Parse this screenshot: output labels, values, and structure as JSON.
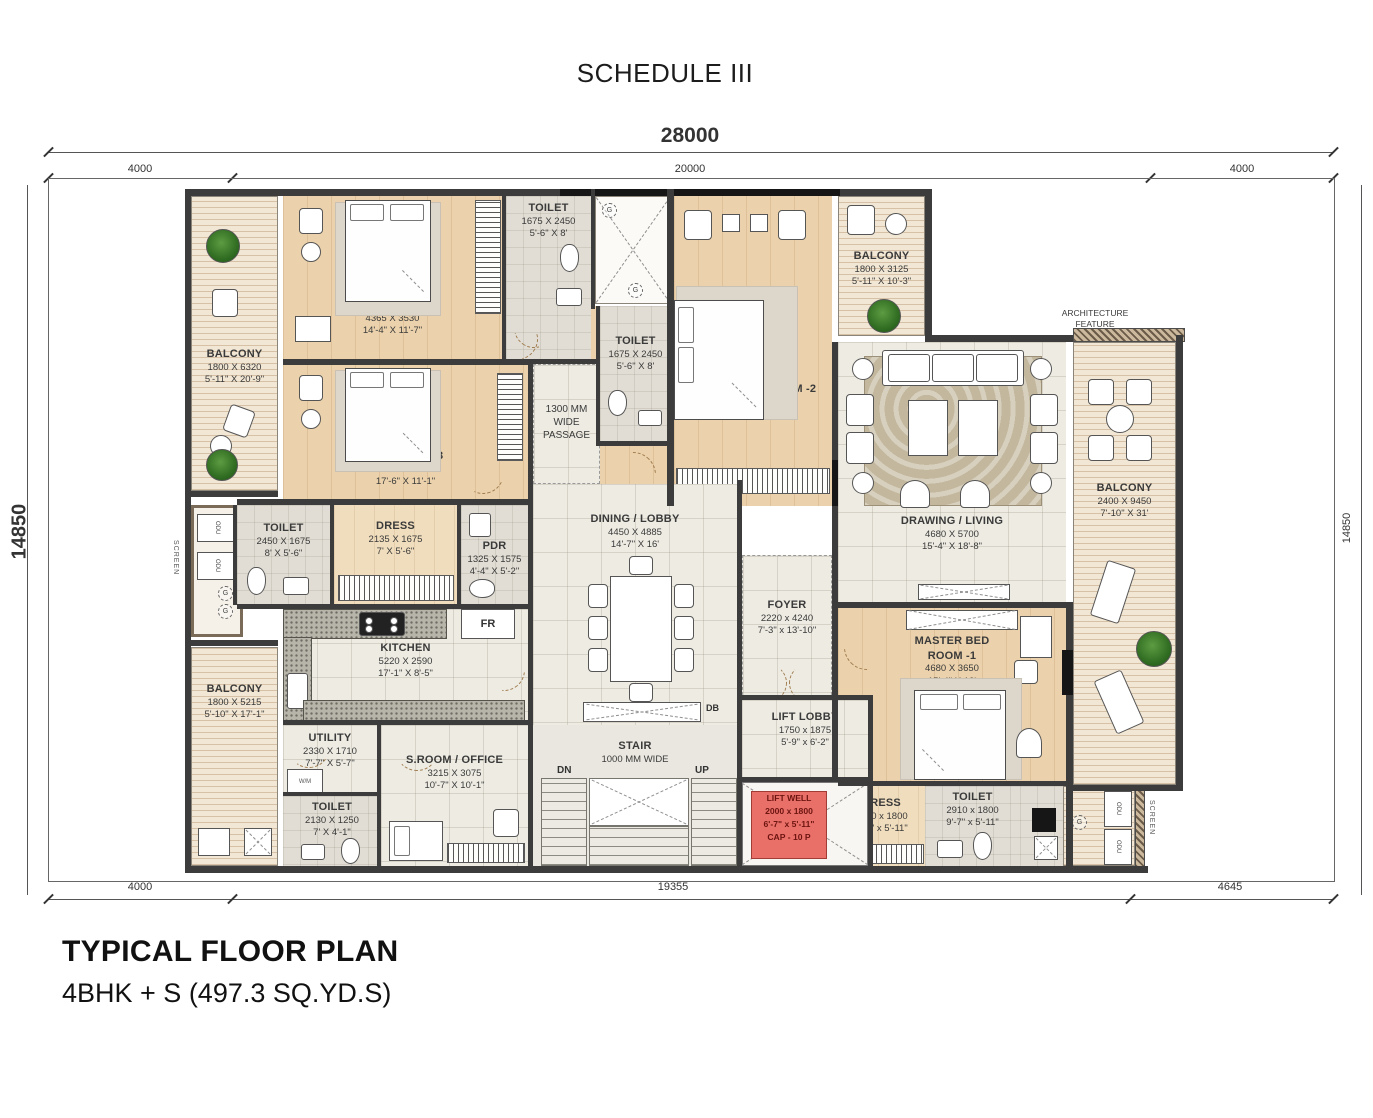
{
  "header": {
    "schedule_title": "SCHEDULE III"
  },
  "footer": {
    "title": "TYPICAL FLOOR PLAN",
    "subtitle": "4BHK + S (497.3 SQ.YD.S)"
  },
  "dimensions": {
    "top_overall": "28000",
    "top_left": "4000",
    "top_center": "20000",
    "top_right": "4000",
    "side_left": "14850",
    "side_right": "14850",
    "bottom_left": "4000",
    "bottom_center": "19355",
    "bottom_right": "4645"
  },
  "rooms": {
    "bedroom4": [
      "BED ROOM -4",
      "4365 X 3530",
      "14'-4\" X 11'-7\""
    ],
    "bedroom3": [
      "BED ROOM -3",
      "5340 X 3380",
      "17'-6\" X 11'-1\""
    ],
    "toilet_top": [
      "TOILET",
      "1675 X 2450",
      "5'-6\" X 8'"
    ],
    "mbr2": [
      "MASTER BED ROOM -2",
      "3595 X 6365",
      "11'-10\" X 20'-11\""
    ],
    "balcony_tl": [
      "BALCONY",
      "1800 X 6320",
      "5'-11\" X 20'-9\""
    ],
    "balcony_tr": [
      "BALCONY",
      "1800 X 3125",
      "5'-11\" X 10'-3\""
    ],
    "drawing": [
      "DRAWING  / LIVING",
      "4680 X 5700",
      "15'-4\" X 18'-8\""
    ],
    "balcony_r": [
      "BALCONY",
      "2400 X 9450",
      "7'-10\" X 31'"
    ],
    "toilet_left": [
      "TOILET",
      "2450 X 1675",
      "8' X 5'-6\""
    ],
    "dress_mid": [
      "DRESS",
      "2135 X 1675",
      "7' X 5'-6\""
    ],
    "pdr": [
      "PDR",
      "1325 X 1575",
      "4'-4\" X 5'-2\""
    ],
    "kitchen": [
      "KITCHEN",
      "5220 X 2590",
      "17'-1\" X 8'-5\""
    ],
    "dining": [
      "DINING / LOBBY",
      "4450 X 4885",
      "14'-7\" X 16'"
    ],
    "foyer": [
      "FOYER",
      "2220 x 4240",
      "7'-3\" x 13'-10\""
    ],
    "mbr1": [
      "MASTER BED",
      "ROOM -1",
      "4680 X 3650",
      "15'-4\" X 12'"
    ],
    "balcony_bl": [
      "BALCONY",
      "1800 X 5215",
      "5'-10\" X 17'-1\""
    ],
    "utility": [
      "UTILITY",
      "2330 X 1710",
      "7'-7\" X 5'-7\""
    ],
    "sroom": [
      "S.ROOM / OFFICE",
      "3215 X 3075",
      "10'-7\" X 10'-1\""
    ],
    "toilet_bl": [
      "TOILET",
      "2130 X 1250",
      "7' X 4'-1\""
    ],
    "stair": [
      "STAIR",
      "1000 MM WIDE"
    ],
    "liftlobby": [
      "LIFT LOBBY",
      "1750 x 1875",
      "5'-9\" x 6'-2\""
    ],
    "liftwell": [
      "LIFT WELL",
      "2000 x 1800",
      "6'-7\" x 5'-11\"",
      "CAP - 10 P"
    ],
    "dress_br": [
      "DRESS",
      "1750 x 1800",
      "5'-9\" x 5'-11\""
    ],
    "toilet_br": [
      "TOILET",
      "2910 x 1800",
      "9'-7\" x 5'-11\""
    ],
    "passage": [
      "1300 MM",
      "WIDE",
      "PASSAGE"
    ],
    "arch": [
      "ARCHITECTURE",
      "FEATURE"
    ]
  },
  "misc": {
    "screen": "SCREEN",
    "odu": "ODU",
    "g": "G",
    "wm": "W/M",
    "fr": "FR",
    "db": "DB",
    "lv": "LV",
    "dn": "DN",
    "up": "UP"
  },
  "colors": {
    "wall": "#3c3c3c",
    "wood_floor": "#ebd2ac",
    "deck": "#f2e7d4",
    "tile": "#edebe2",
    "bath": "#e1ddd4",
    "carpet": "#c3b79d",
    "lift_well_red": "#e97069"
  }
}
